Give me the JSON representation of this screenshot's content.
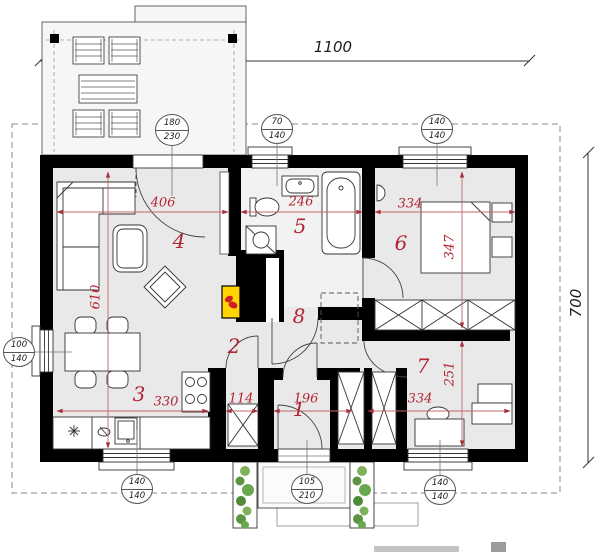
{
  "plan_title": "single-storey house floor plan",
  "overall": {
    "width": "1100",
    "depth": "700"
  },
  "rooms": {
    "entry": "1",
    "pantry": "2",
    "kitchen": "3",
    "living": "4",
    "bathroom": "5",
    "bedroom": "6",
    "office": "7",
    "hall": "8"
  },
  "dims": {
    "living_width": "406",
    "bathroom_width": "246",
    "bedroom_width": "334",
    "living_height": "610",
    "bedroom_height": "347",
    "kitchen_width": "330",
    "pantry_width": "114",
    "entry_width": "196",
    "closet_width": "334",
    "office_height": "251"
  },
  "callouts": {
    "terrace_door": {
      "w": "180",
      "h": "230"
    },
    "bath_window": {
      "w": "70",
      "h": "140"
    },
    "bedroom_window": {
      "w": "140",
      "h": "140"
    },
    "dining_window": {
      "w": "100",
      "h": "140"
    },
    "kitchen_window": {
      "w": "140",
      "h": "140"
    },
    "entry_door": {
      "w": "105",
      "h": "210"
    },
    "office_window": {
      "w": "140",
      "h": "140"
    }
  },
  "colors": {
    "wall": "#000000",
    "dim_red": "#b32433",
    "boiler_yellow": "#ffd400",
    "flame_red": "#cf1f2f",
    "plant_green": "#6fae4e",
    "floor_gray": "#e9e9e9"
  }
}
